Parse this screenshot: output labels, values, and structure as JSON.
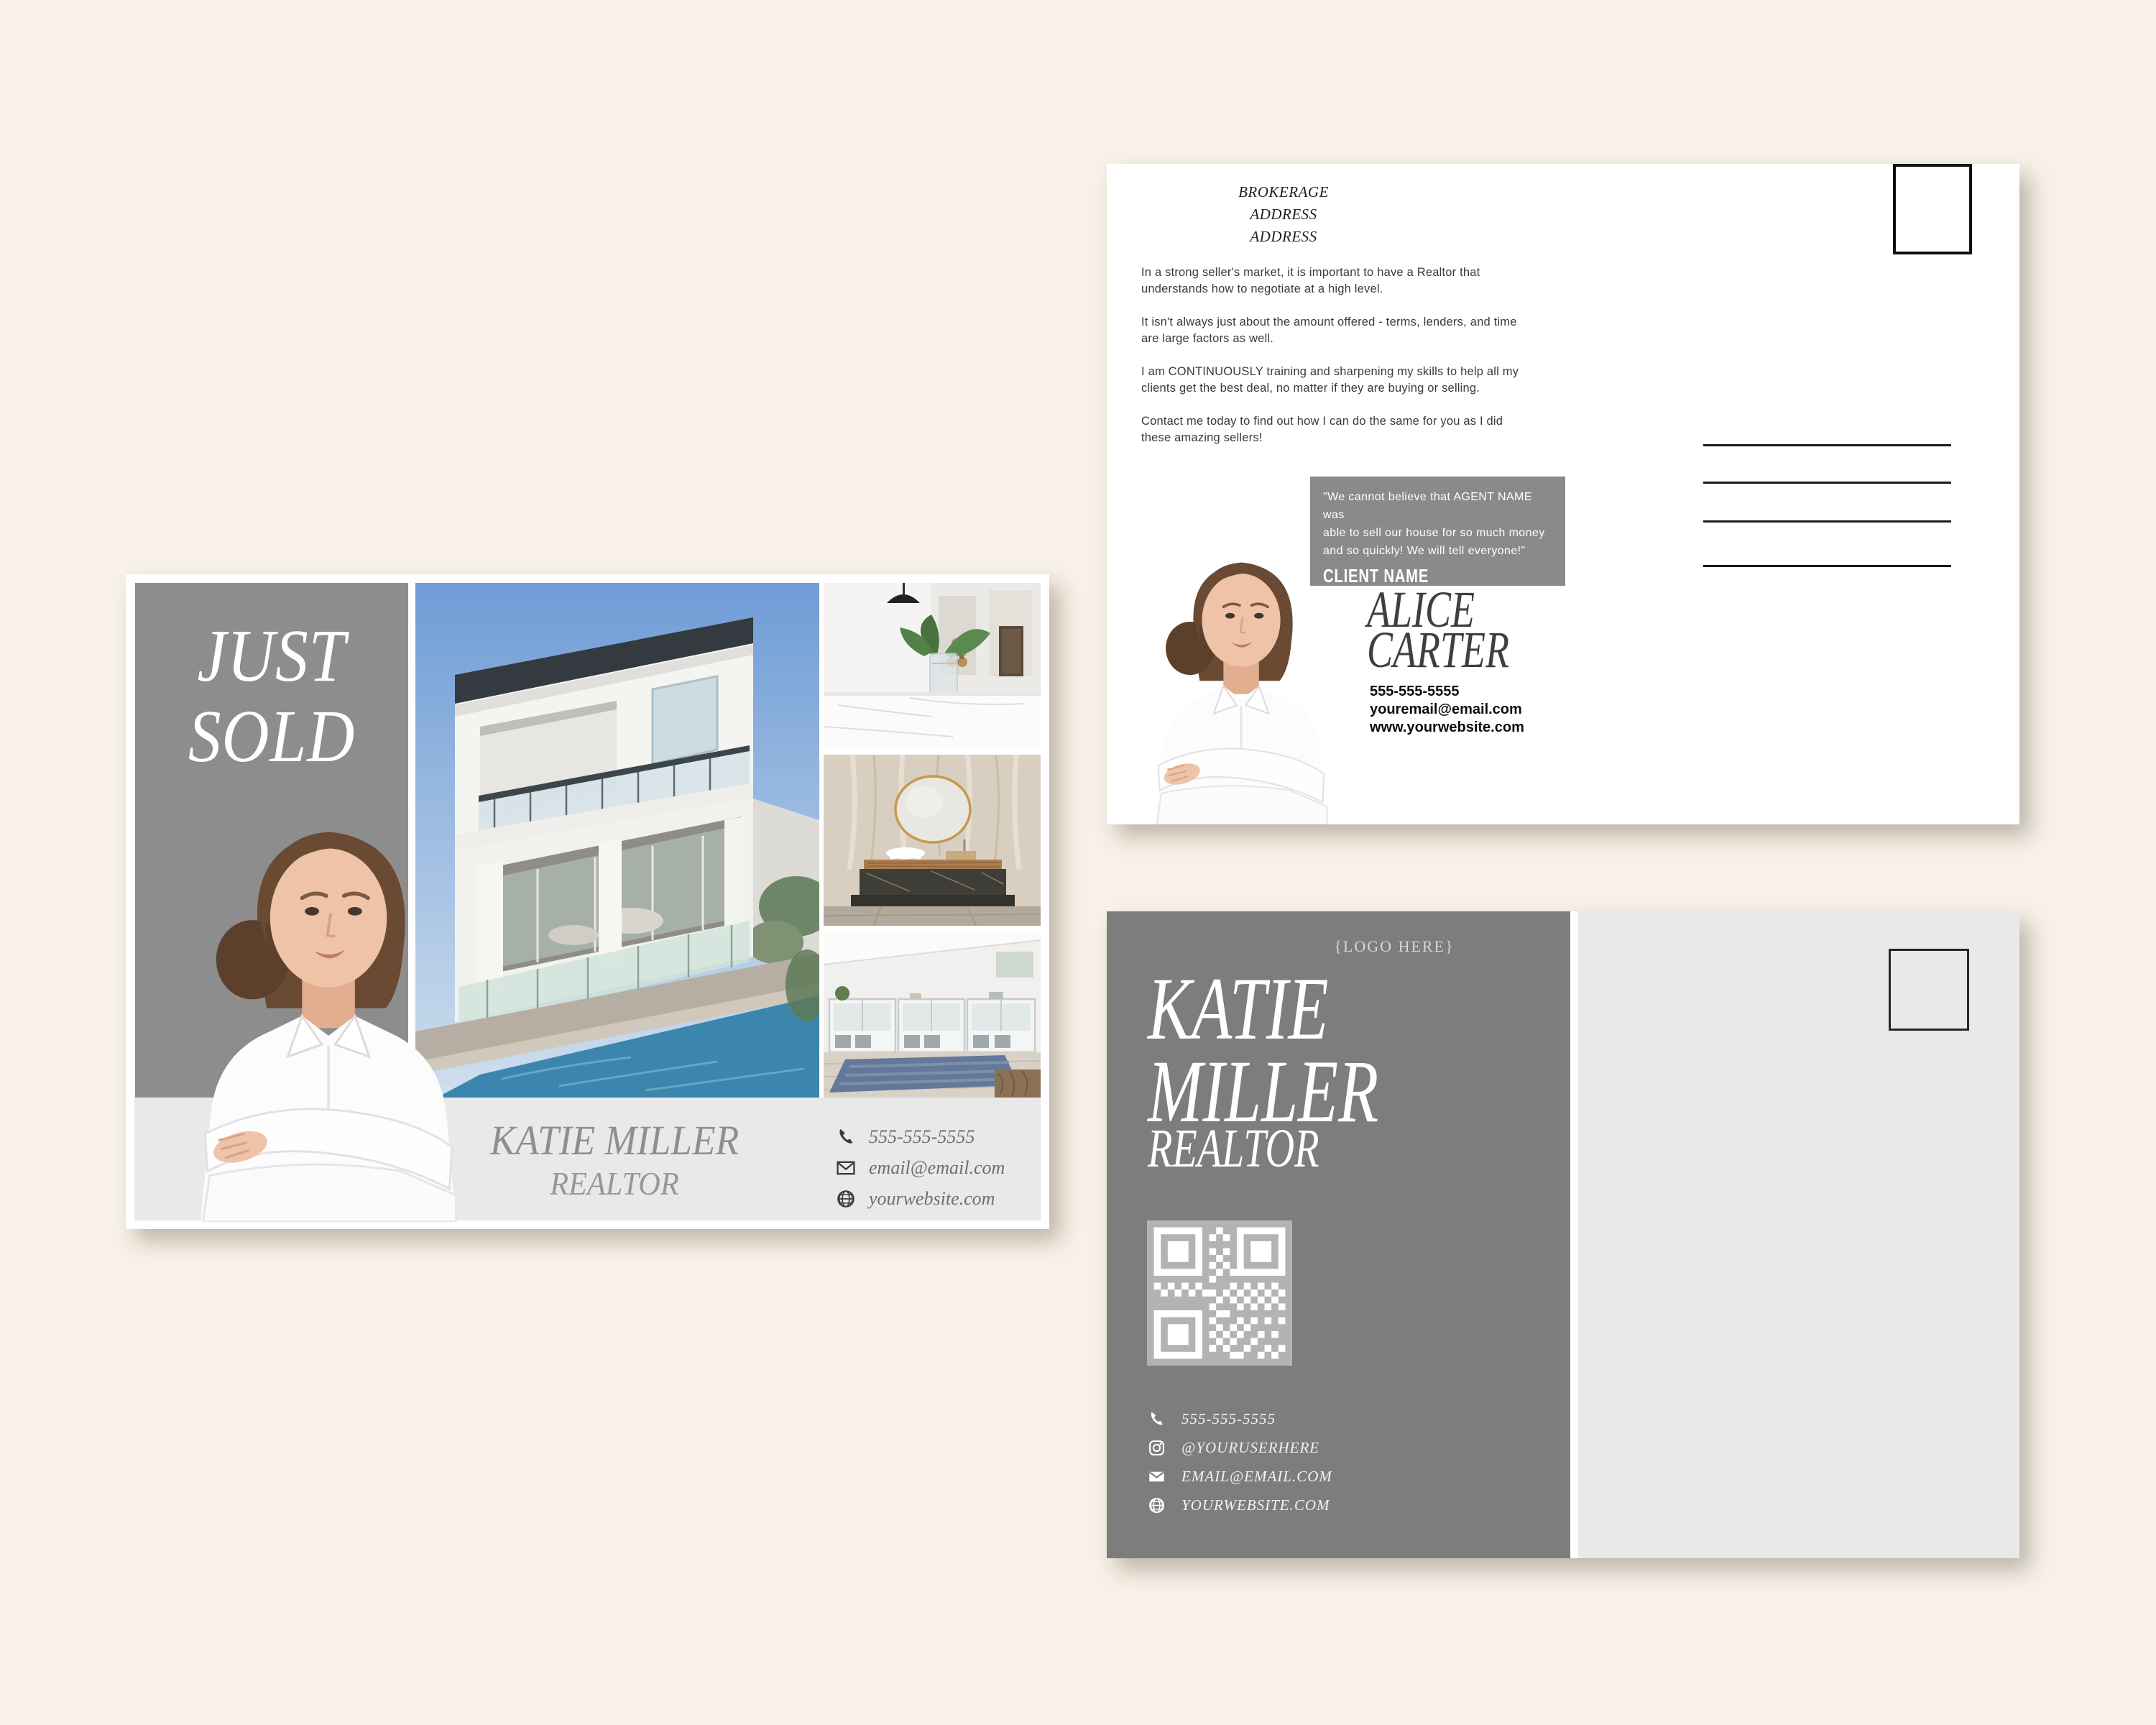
{
  "canvas": {
    "background": "#f7f1e7"
  },
  "front_card": {
    "headline": {
      "line1": "JUST",
      "line2": "SOLD"
    },
    "footer": {
      "name": "KATIE MILLER",
      "title": "REALTOR",
      "contacts": {
        "phone": "555-555-5555",
        "email": "email@email.com",
        "website": "yourwebsite.com"
      }
    }
  },
  "back_top_card": {
    "brokerage": {
      "line1": "BROKERAGE",
      "line2": "ADDRESS",
      "line3": "ADDRESS"
    },
    "paragraphs": {
      "p1": "In a strong seller's market, it is important to have a Realtor that\nunderstands how to negotiate at a high level.",
      "p2": "It isn't always just about the amount offered - terms, lenders, and time\nare large factors as well.",
      "p3": "I am CONTINUOUSLY training and sharpening my skills to help all my\nclients get the best deal, no matter if they are buying or selling.",
      "p4": "Contact me today to find out how I can do the same for you as I did\nthese amazing sellers!"
    },
    "testimonial": {
      "quote": "\"We cannot believe that AGENT NAME was\nable to sell our house for so much money\nand so quickly! We will tell everyone!\"",
      "client_name": "CLIENT NAME"
    },
    "agent": {
      "first_name": "ALICE",
      "last_name": "CARTER"
    },
    "contacts": {
      "phone": "555-555-5555",
      "email": "youremail@email.com",
      "website": "www.yourwebsite.com"
    }
  },
  "back_bottom_card": {
    "logo_placeholder": "{LOGO HERE}",
    "agent": {
      "first_name": "KATIE",
      "last_name": "MILLER",
      "title": "REALTOR"
    },
    "contacts": {
      "phone": "555-555-5555",
      "instagram": "@YOURUSERHERE",
      "email": "EMAIL@EMAIL.COM",
      "website": "YOURWEBSITE.COM"
    }
  },
  "colors": {
    "cream_background": "#f7f1e7",
    "panel_gray": "#8d8d8d",
    "panel_gray_dark": "#7d7d7d",
    "testimonial_gray": "#8a8a8a",
    "light_strip": "#e9e9ea",
    "qr_background": "#b3b3b3"
  }
}
